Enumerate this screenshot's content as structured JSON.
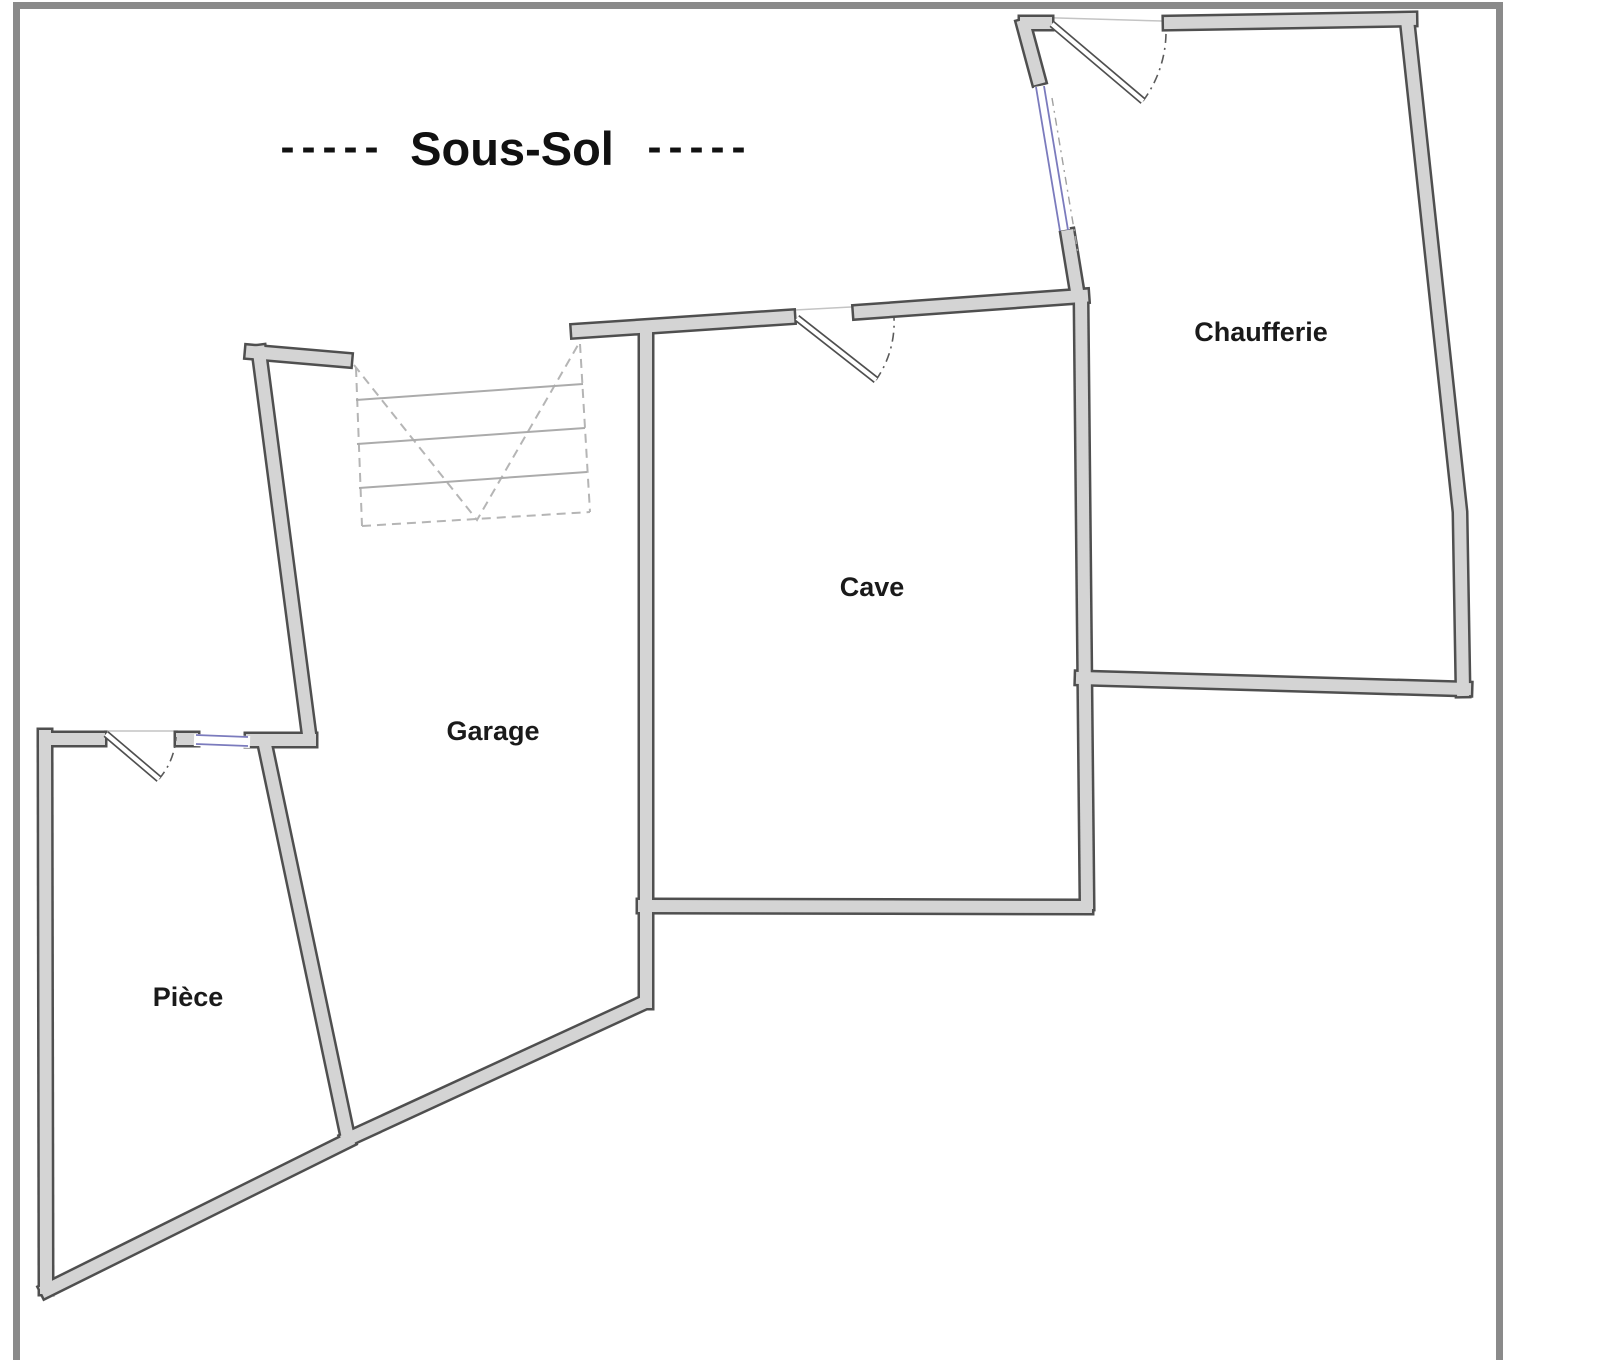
{
  "title": {
    "prefix": "-----",
    "text": "Sous-Sol",
    "suffix": "-----"
  },
  "rooms": {
    "chaufferie": {
      "label": "Chaufferie"
    },
    "cave": {
      "label": "Cave"
    },
    "garage": {
      "label": "Garage"
    },
    "piece": {
      "label": "Pièce"
    }
  },
  "colors": {
    "frame": "#8a8a8a",
    "wall_fill": "#d4d4d4",
    "wall_outline": "#4f4f4f",
    "stair_line": "#ababab",
    "stair_dash": "#b5b5b5",
    "window": "#7b7bbd",
    "arc": "#5a5a5a",
    "header_line": "#c4c4c4",
    "label": "#1a1a1a"
  }
}
